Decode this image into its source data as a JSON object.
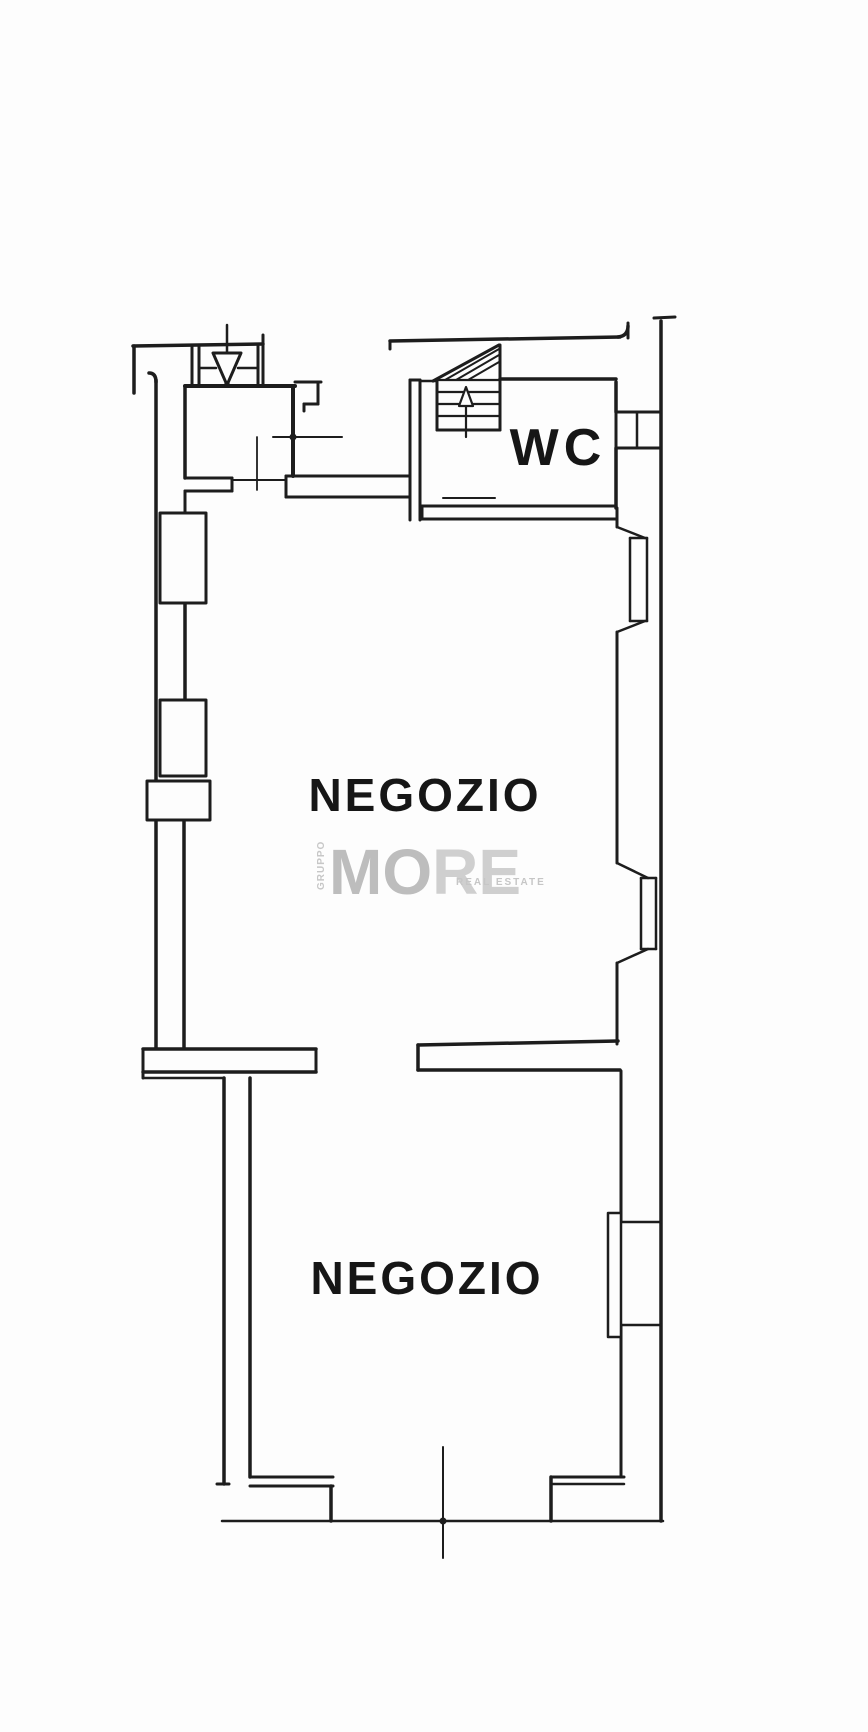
{
  "document": {
    "kind_label": "scanned floor plan",
    "paper_color": "#fdfdfd",
    "ink_color": "#1d1d1d",
    "label_color": "#161616"
  },
  "rooms": {
    "upper_shop": {
      "label": "NEGOZIO"
    },
    "lower_shop": {
      "label": "NEGOZIO"
    },
    "wc": {
      "label": "WC"
    }
  },
  "watermark": {
    "group_word": "GRUPPO",
    "brand_left": "MO",
    "brand_right": "RE",
    "tagline": "REAL ESTATE",
    "color_primary": "#bdbdbd",
    "color_secondary": "#cfcfcf"
  },
  "plan": {
    "ink": "#1d1d1d",
    "paper": "#fdfdfd",
    "lines": [
      [
        133,
        346,
        263,
        344,
        3.5,
        "top-boundary-left"
      ],
      [
        134,
        346,
        134,
        393,
        3.5,
        "left-boundary-stub"
      ],
      [
        192,
        346,
        192,
        386,
        3,
        "entrance-jamb"
      ],
      [
        199,
        346,
        199,
        386,
        3,
        "entrance-jamb"
      ],
      [
        258,
        346,
        258,
        386,
        3,
        "entrance-jamb"
      ],
      [
        263,
        335,
        263,
        386,
        3,
        "entrance-jamb"
      ],
      [
        199,
        368,
        216,
        368,
        2.5,
        "entrance-sill"
      ],
      [
        238,
        368,
        258,
        368,
        2.5,
        "entrance-sill"
      ],
      [
        227,
        325,
        227,
        353,
        2.5,
        "entrance-door-axis"
      ],
      [
        185,
        386,
        295,
        386,
        4,
        "vestibule-top-wall"
      ],
      [
        293,
        386,
        293,
        476,
        4,
        "vestibule-right-wall"
      ],
      [
        295,
        382,
        321,
        382,
        3,
        "door-jamb"
      ],
      [
        318,
        382,
        318,
        404,
        3,
        "door-jamb"
      ],
      [
        304,
        404,
        318,
        404,
        3,
        "door-jamb"
      ],
      [
        304,
        404,
        304,
        411,
        3,
        "door-jamb"
      ],
      [
        273,
        437,
        342,
        437,
        2,
        "door-swing-axis"
      ],
      [
        257,
        437,
        257,
        490,
        1.8,
        "door-swing-axis"
      ],
      [
        156,
        380,
        156,
        1048,
        3.5,
        "left-outer-wall"
      ],
      [
        185,
        386,
        185,
        478,
        3.5,
        "left-inner-wall"
      ],
      [
        185,
        491,
        185,
        513,
        3,
        "left-inner-wall"
      ],
      [
        185,
        603,
        185,
        700,
        3.5,
        "left-inner-wall"
      ],
      [
        184,
        820,
        184,
        1048,
        3.5,
        "left-inner-wall"
      ],
      [
        185,
        478,
        232,
        478,
        3,
        "vestibule-bottom-wall"
      ],
      [
        185,
        491,
        232,
        491,
        3,
        "vestibule-bottom-wall"
      ],
      [
        232,
        478,
        232,
        491,
        3,
        "wall-end-cap"
      ],
      [
        232,
        480,
        286,
        480,
        2,
        "door-threshold"
      ],
      [
        286,
        476,
        410,
        476,
        3,
        "upper-cross-wall"
      ],
      [
        286,
        497,
        410,
        497,
        3,
        "upper-cross-wall"
      ],
      [
        286,
        476,
        286,
        497,
        3,
        "wall-end-cap"
      ],
      [
        174,
        513,
        174,
        603,
        2.2,
        "window-frame"
      ],
      [
        174,
        700,
        174,
        776,
        2.2,
        "window-frame"
      ],
      [
        147,
        799,
        210,
        799,
        2.5,
        "pillar-midline"
      ],
      [
        143,
        1049,
        316,
        1049,
        3.5,
        "dividing-wall-left"
      ],
      [
        143,
        1072,
        316,
        1072,
        3.5,
        "dividing-wall-left"
      ],
      [
        316,
        1049,
        316,
        1072,
        3,
        "wall-end-cap"
      ],
      [
        143,
        1049,
        143,
        1078,
        3,
        "wall-end-cap"
      ],
      [
        143,
        1078,
        224,
        1078,
        2.5,
        "dividing-wall-left"
      ],
      [
        224,
        1078,
        224,
        1484,
        3.5,
        "lower-left-outer-wall"
      ],
      [
        250,
        1078,
        250,
        1477,
        3.5,
        "lower-left-inner-wall"
      ],
      [
        217,
        1484,
        229,
        1484,
        3,
        "wall-foot"
      ],
      [
        250,
        1477,
        333,
        1477,
        3,
        "lower-left-step"
      ],
      [
        250,
        1486,
        333,
        1486,
        3,
        "lower-left-step"
      ],
      [
        331,
        1486,
        331,
        1521,
        3.5,
        "shopfront-jamb"
      ],
      [
        222,
        1521,
        663,
        1521,
        2.5,
        "shopfront-threshold"
      ],
      [
        443,
        1447,
        443,
        1558,
        2,
        "door-axis-bottom"
      ],
      [
        551,
        1477,
        551,
        1521,
        3.5,
        "shopfront-jamb"
      ],
      [
        551,
        1477,
        624,
        1477,
        3,
        "lower-right-step"
      ],
      [
        553,
        1484,
        624,
        1484,
        2.5,
        "lower-right-step"
      ],
      [
        628,
        323,
        628,
        338,
        3,
        "top-right-corner-stub"
      ],
      [
        616,
        382,
        616,
        412,
        3.5,
        "wc-right-wall"
      ],
      [
        616,
        412,
        616,
        448,
        3,
        "window-frame"
      ],
      [
        616,
        448,
        616,
        508,
        3.5,
        "wc-right-wall"
      ],
      [
        617,
        508,
        617,
        527,
        3,
        "right-inner-wall"
      ],
      [
        617,
        632,
        617,
        863,
        3,
        "right-inner-wall"
      ],
      [
        617,
        963,
        617,
        1044,
        3,
        "right-inner-wall"
      ],
      [
        621,
        1071,
        621,
        1222,
        3,
        "right-inner-wall"
      ],
      [
        621,
        1325,
        621,
        1477,
        3,
        "right-inner-wall"
      ],
      [
        661,
        321,
        661,
        1521,
        3.5,
        "right-outer-wall"
      ],
      [
        654,
        318,
        675,
        317,
        3,
        "top-right-corner-dash"
      ],
      [
        390,
        341,
        620,
        337,
        3.5,
        "top-boundary-right"
      ],
      [
        390,
        341,
        390,
        349,
        3,
        "wall-end-hook"
      ],
      [
        500,
        379,
        616,
        379,
        3.5,
        "wc-top-wall"
      ],
      [
        422,
        506,
        616,
        506,
        3,
        "wc-bottom-wall"
      ],
      [
        422,
        519,
        616,
        519,
        3,
        "wc-bottom-wall"
      ],
      [
        422,
        506,
        422,
        519,
        3,
        "wall-end-cap"
      ],
      [
        443,
        498,
        495,
        498,
        2,
        "threshold-line"
      ],
      [
        410,
        380,
        410,
        520,
        3,
        "stair-left-wall"
      ],
      [
        420,
        380,
        420,
        520,
        3,
        "stair-left-wall"
      ],
      [
        410,
        380,
        420,
        380,
        3,
        "wall-end-cap"
      ],
      [
        421,
        381,
        437,
        381,
        2.5,
        "stair-connector"
      ],
      [
        500,
        345,
        500,
        430,
        3,
        "stair-right-edge"
      ],
      [
        437,
        430,
        500,
        430,
        3,
        "stair-bottom-edge"
      ],
      [
        437,
        381,
        437,
        430,
        3,
        "stair-left-edge"
      ],
      [
        433,
        381,
        499,
        345,
        3,
        "stair-diagonal"
      ],
      [
        445,
        380,
        499,
        349,
        2,
        "stair-hatch"
      ],
      [
        456,
        380,
        499,
        355,
        2,
        "stair-hatch"
      ],
      [
        468,
        380,
        499,
        362,
        2,
        "stair-hatch"
      ],
      [
        437,
        380,
        500,
        380,
        2.2,
        "stair-tread"
      ],
      [
        437,
        392,
        500,
        392,
        2.2,
        "stair-tread"
      ],
      [
        437,
        404,
        500,
        404,
        2.2,
        "stair-tread"
      ],
      [
        437,
        416,
        500,
        416,
        2.2,
        "stair-tread"
      ],
      [
        466,
        406,
        466,
        437,
        2.2,
        "stair-arrow-stem"
      ],
      [
        616,
        412,
        661,
        412,
        3,
        "window-frame"
      ],
      [
        616,
        448,
        661,
        448,
        3,
        "window-frame"
      ],
      [
        637,
        412,
        637,
        448,
        2.5,
        "window-frame"
      ],
      [
        617,
        527,
        645,
        538,
        2.5,
        "window-reveal"
      ],
      [
        617,
        632,
        645,
        621,
        2.5,
        "window-reveal"
      ],
      [
        630,
        538,
        630,
        621,
        2.5,
        "window-frame"
      ],
      [
        647,
        538,
        647,
        621,
        2.5,
        "window-frame"
      ],
      [
        630,
        538,
        647,
        538,
        2.5,
        "window-frame"
      ],
      [
        630,
        621,
        647,
        621,
        2.5,
        "window-frame"
      ],
      [
        617,
        863,
        648,
        878,
        2.5,
        "window-reveal"
      ],
      [
        617,
        963,
        648,
        949,
        2.5,
        "window-reveal"
      ],
      [
        641,
        878,
        641,
        949,
        2.5,
        "window-frame"
      ],
      [
        656,
        878,
        656,
        949,
        2.5,
        "window-frame"
      ],
      [
        641,
        878,
        656,
        878,
        2.5,
        "window-frame"
      ],
      [
        641,
        949,
        656,
        949,
        2.5,
        "window-frame"
      ],
      [
        621,
        1222,
        661,
        1222,
        2.5,
        "window-frame"
      ],
      [
        621,
        1325,
        661,
        1325,
        2.5,
        "window-frame"
      ],
      [
        418,
        1045,
        618,
        1041,
        3.5,
        "dividing-wall-right"
      ],
      [
        418,
        1070,
        620,
        1070,
        3.5,
        "dividing-wall-right"
      ],
      [
        418,
        1045,
        418,
        1070,
        3.5,
        "wall-end-cap"
      ]
    ],
    "rects": [
      [
        160,
        513,
        46,
        90,
        3,
        "left-wall-window-upper"
      ],
      [
        160,
        700,
        46,
        76,
        3,
        "left-wall-window-lower"
      ],
      [
        147,
        781,
        63,
        39,
        3,
        "left-wall-pillar"
      ],
      [
        608,
        1213,
        13,
        124,
        2.5,
        "right-wall-window-sill"
      ]
    ],
    "polys": [
      {
        "pts": "213,353 241,353 227,385",
        "sw": 3,
        "name": "entrance-arrow-down"
      },
      {
        "pts": "459,406 473,406 466,387",
        "sw": 2.2,
        "name": "stair-arrow-up"
      }
    ],
    "circles": [
      [
        293,
        437,
        3.5,
        "door-hinge-dot"
      ],
      [
        443,
        1521,
        3.5,
        "door-hinge-dot"
      ],
      [
        227,
        385,
        3,
        "entrance-arrow-tip-dot"
      ]
    ],
    "paths": [
      [
        "M 149,373 Q 156,373 156,382",
        3.5,
        "left-wall-top-corner"
      ],
      [
        "M 618,337 Q 628,336 628,326",
        3.5,
        "top-right-corner-arc"
      ]
    ]
  }
}
